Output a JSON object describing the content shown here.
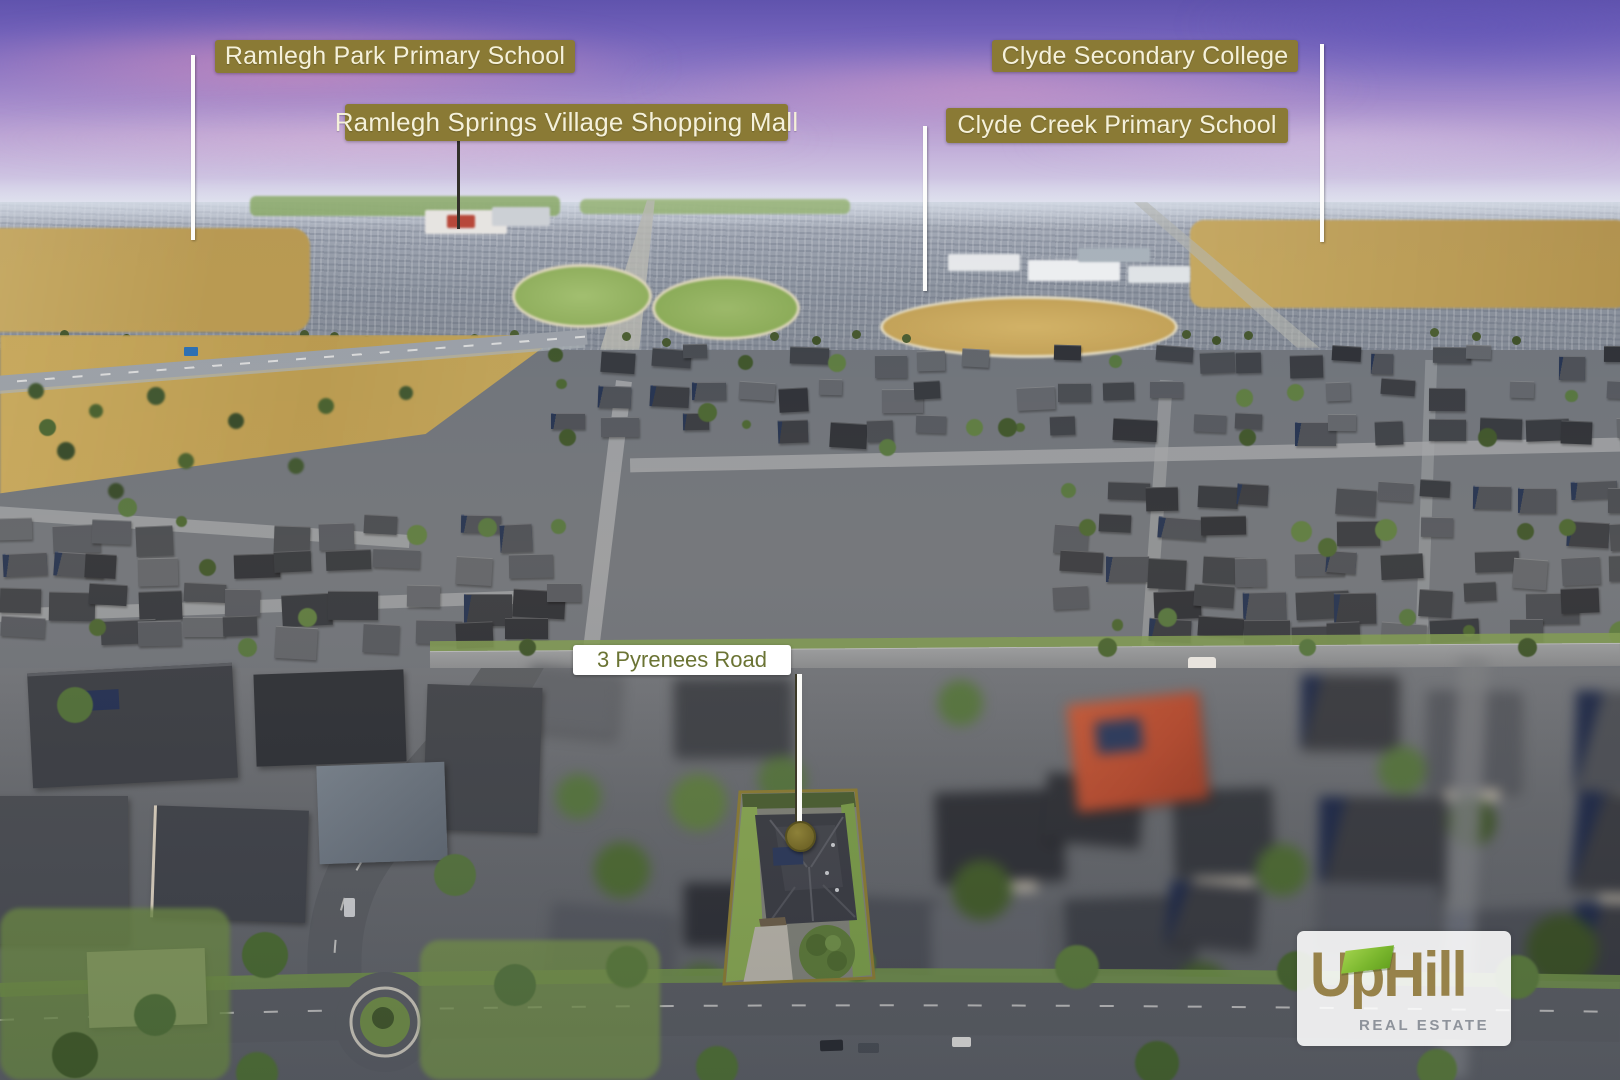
{
  "labels": {
    "ramlegh_park": "Ramlegh Park Primary School",
    "ramlegh_springs": "Ramlegh Springs Village Shopping Mall",
    "clyde_secondary": "Clyde Secondary College",
    "clyde_creek": "Clyde Creek Primary School",
    "address": "3 Pyrenees Road"
  },
  "logo": {
    "up": "Up",
    "hill": "Hill",
    "tagline": "REAL ESTATE"
  },
  "colors": {
    "label_bg": "#8a7a35",
    "label_text": "#f5f1da",
    "addr_bg": "#ffffff",
    "addr_text": "#6b7434",
    "olive": "#8a7c35",
    "pin": "#7b702d",
    "ptr_white": "#fdfdfb",
    "ptr_dark": "#32302a",
    "logo_gold": "#97824a",
    "logo_green": "#7cb82f",
    "logo_gray": "#8e939b",
    "sky_top": "#5f53ae",
    "sky_cloud_pink": "#e0a0c4",
    "park_grass_dry": "#c5a257",
    "playground_softfall": "#bb6229",
    "field_green": "#8fae5d",
    "roof_charcoal": "#3a3d45",
    "roof_red": "#b44a30",
    "road_asphalt": "#595d63"
  }
}
